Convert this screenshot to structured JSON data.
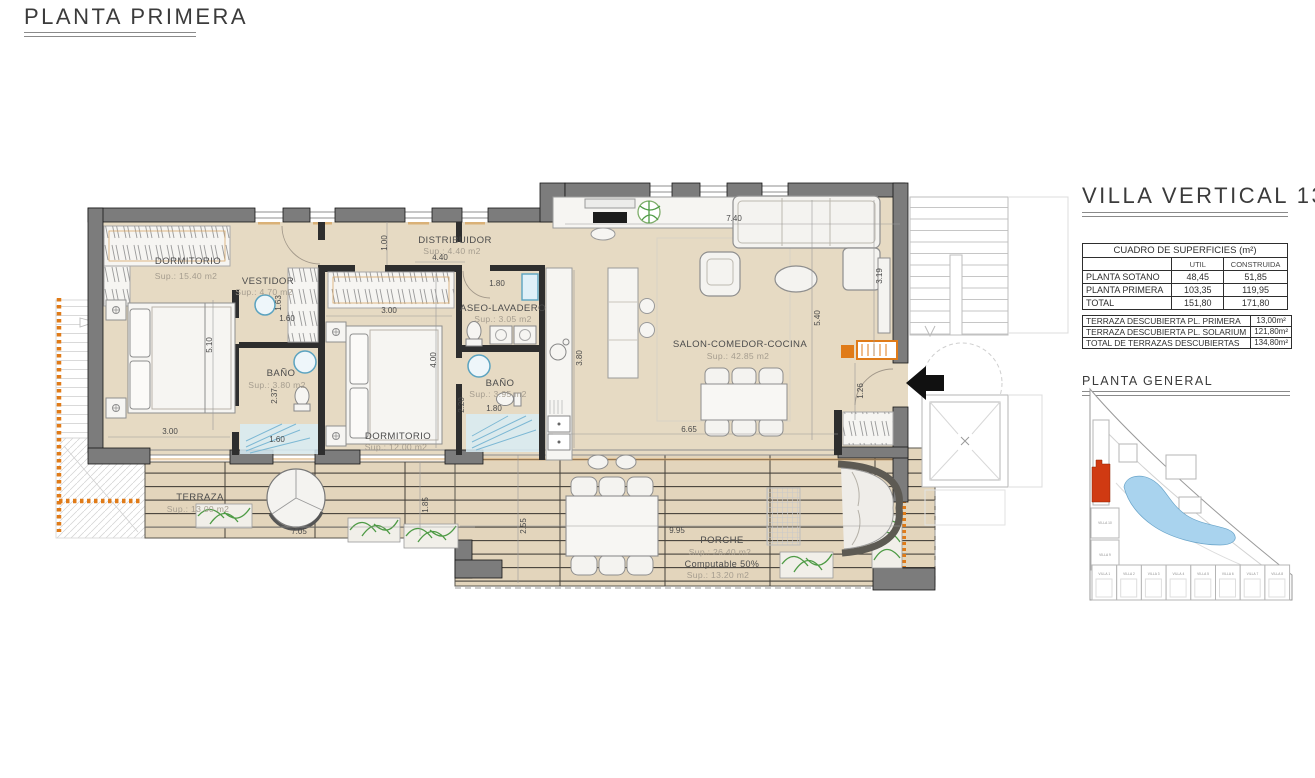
{
  "page": {
    "title": "PLANTA PRIMERA"
  },
  "panel": {
    "title": "VILLA VERTICAL 13",
    "surfaces_table": {
      "title": "CUADRO DE SUPERFICIES (m²)",
      "col_headers": [
        "UTIL",
        "CONSTRUIDA"
      ],
      "rows": [
        {
          "label": "PLANTA SOTANO",
          "util": "48,45",
          "construida": "51,85"
        },
        {
          "label": "PLANTA PRIMERA",
          "util": "103,35",
          "construida": "119,95"
        },
        {
          "label": "TOTAL",
          "util": "151,80",
          "construida": "171,80"
        }
      ]
    },
    "terrace_table": {
      "rows": [
        {
          "label": "TERRAZA DESCUBIERTA PL. PRIMERA",
          "value": "13,00m²"
        },
        {
          "label": "TERRAZA DESCUBIERTA PL. SOLARIUM",
          "value": "121,80m²"
        },
        {
          "label": "TOTAL DE TERRAZAS DESCUBIERTAS",
          "value": "134,80m²"
        }
      ]
    },
    "site_plan": {
      "title": "PLANTA  GENERAL",
      "highlight_color": "#d03a12",
      "pool_color": "#a9d3ee",
      "villas_bottom": [
        "VILLA 1",
        "VILLA 2",
        "VILLA 3",
        "VILLA 4",
        "VILLA 5",
        "VILLA 6",
        "VILLA 7",
        "VILLA 8"
      ],
      "villas_left": [
        "VILLA 10",
        "VILLA 9"
      ]
    }
  },
  "plan": {
    "rooms": [
      {
        "name": "DORMITORIO",
        "sup": "Sup.: 15.40  m2"
      },
      {
        "name": "VESTIDOR",
        "sup": "Sup.: 4.70   m2"
      },
      {
        "name": "BAÑO",
        "sup": "Sup.: 3.80   m2"
      },
      {
        "name": "DISTRIBUIDOR",
        "sup": "Sup.: 4.40   m2"
      },
      {
        "name": "DORMITORIO",
        "sup": "Sup.: 12.00  m2"
      },
      {
        "name": "ASEO-LAVADERO",
        "sup": "Sup.: 3.05   m2"
      },
      {
        "name": "BAÑO",
        "sup": "Sup.: 3.95   m2"
      },
      {
        "name": "SALON-COMEDOR-COCINA",
        "sup": "Sup.: 42.85  m2"
      },
      {
        "name": "TERRAZA",
        "sup": "Sup.: 13.00  m2"
      },
      {
        "name": "PORCHE",
        "sup": "Sup.: 26.40  m2",
        "note": "Computable 50%",
        "sup2": "Sup.: 13.20  m2"
      }
    ],
    "dims": [
      "5.10",
      "3.00",
      "1.63",
      "1.60",
      "2.37",
      "1.60",
      "1.00",
      "4.40",
      "3.00",
      "1.80",
      "4.00",
      "2.20",
      "1.80",
      "3.80",
      "7.40",
      "3.19",
      "5.40",
      "1.26",
      "6.65",
      "7.05",
      "1.85",
      "2.55",
      "9.95"
    ]
  },
  "colors": {
    "floor": "#e6dac3",
    "wall": "#7c7c7c",
    "accent_orange": "#e07b18",
    "shower_blue": "#d8ecf4",
    "plant_green": "#4e9b45"
  }
}
